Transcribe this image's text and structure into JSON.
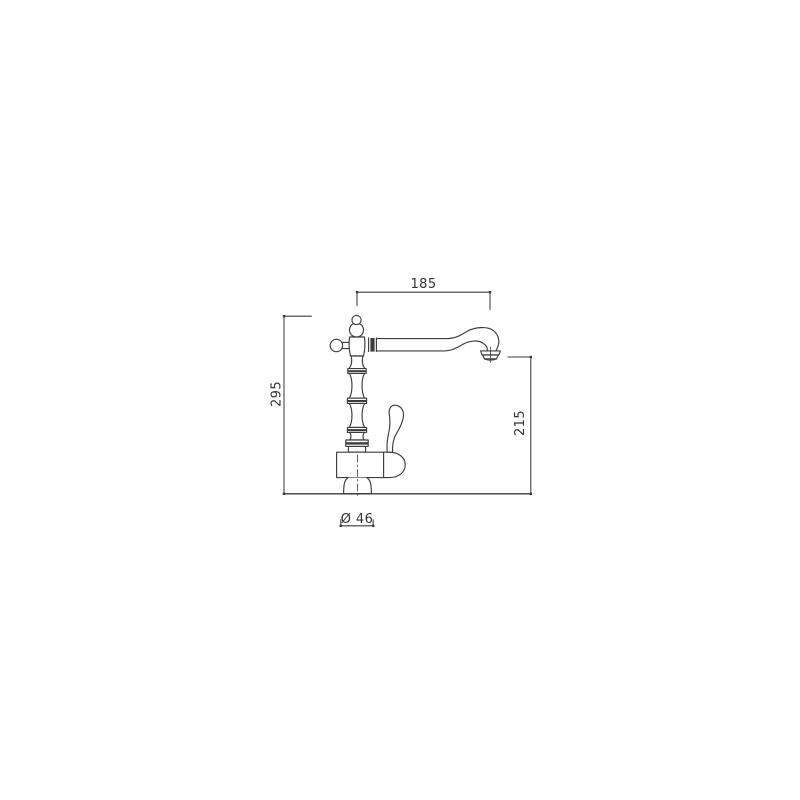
{
  "canvas": {
    "background_color": "#ffffff",
    "line_color": "#3d3d3d",
    "text_color": "#333333"
  },
  "drawing": {
    "type": "technical-dimension-diagram",
    "subject": "classic single-lever kitchen faucet, side elevation",
    "dimensions": {
      "spout_reach": "185",
      "total_height": "295",
      "outlet_height": "215",
      "base_diameter": "Ø 46"
    }
  }
}
